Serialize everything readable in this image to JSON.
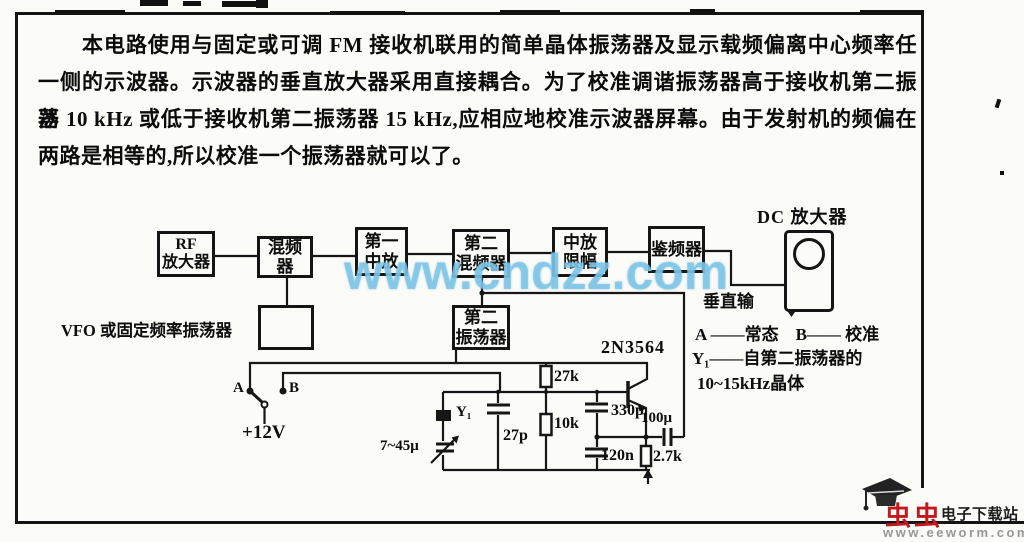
{
  "paragraph": {
    "lines": [
      "本电路使用与固定或可调 FM 接收机联用的简单晶体振荡器及显示载频偏离中心频率任",
      "一侧的示波器。示波器的垂直放大器采用直接耦合。为了校准调谐振荡器高于接收机第二振荡",
      "器 10 kHz 或低于接收机第二振荡器 15 kHz,应相应地校准示波器屏幕。由于发射机的频偏在",
      "两路是相等的,所以校准一个振荡器就可以了。"
    ]
  },
  "watermark": "www.cndzz.com",
  "diagram": {
    "blocks": {
      "rf": "RF\n放大器",
      "mixer1": "混频器",
      "if1": "第一\n中放",
      "mixer2": "第二\n混频器",
      "limiter": "中放\n限幅",
      "discriminator": "鉴频器",
      "osc2": "第二\n振荡器"
    },
    "labels": {
      "vfo": "VFO 或固定频率振荡器",
      "dc_amp": "DC 放大器",
      "vertical_input": "垂直输",
      "transistor": "2N3564",
      "supply": "+12V",
      "switch_a": "A",
      "switch_b": "B",
      "r_27k": "27k",
      "r_10k": "10k",
      "r_2k7": "2.7k",
      "c_27p": "27p",
      "c_330p": "330p",
      "c_120n": "120n",
      "c_100u": "100μ",
      "trimmer": "7~45μ",
      "crystal": "Y₁"
    },
    "legend": {
      "line1": "A ——常态　B—— 校准",
      "line2": "Y₁——自第二振荡器的",
      "line3": "10~15kHz晶体"
    }
  },
  "footer": {
    "site_name": "虫虫",
    "site_desc": "电子下载站",
    "site_url": "www.eeworm.com"
  },
  "colors": {
    "watermark_blue": "#7ec6e8",
    "logo_red": "#c3191e"
  }
}
